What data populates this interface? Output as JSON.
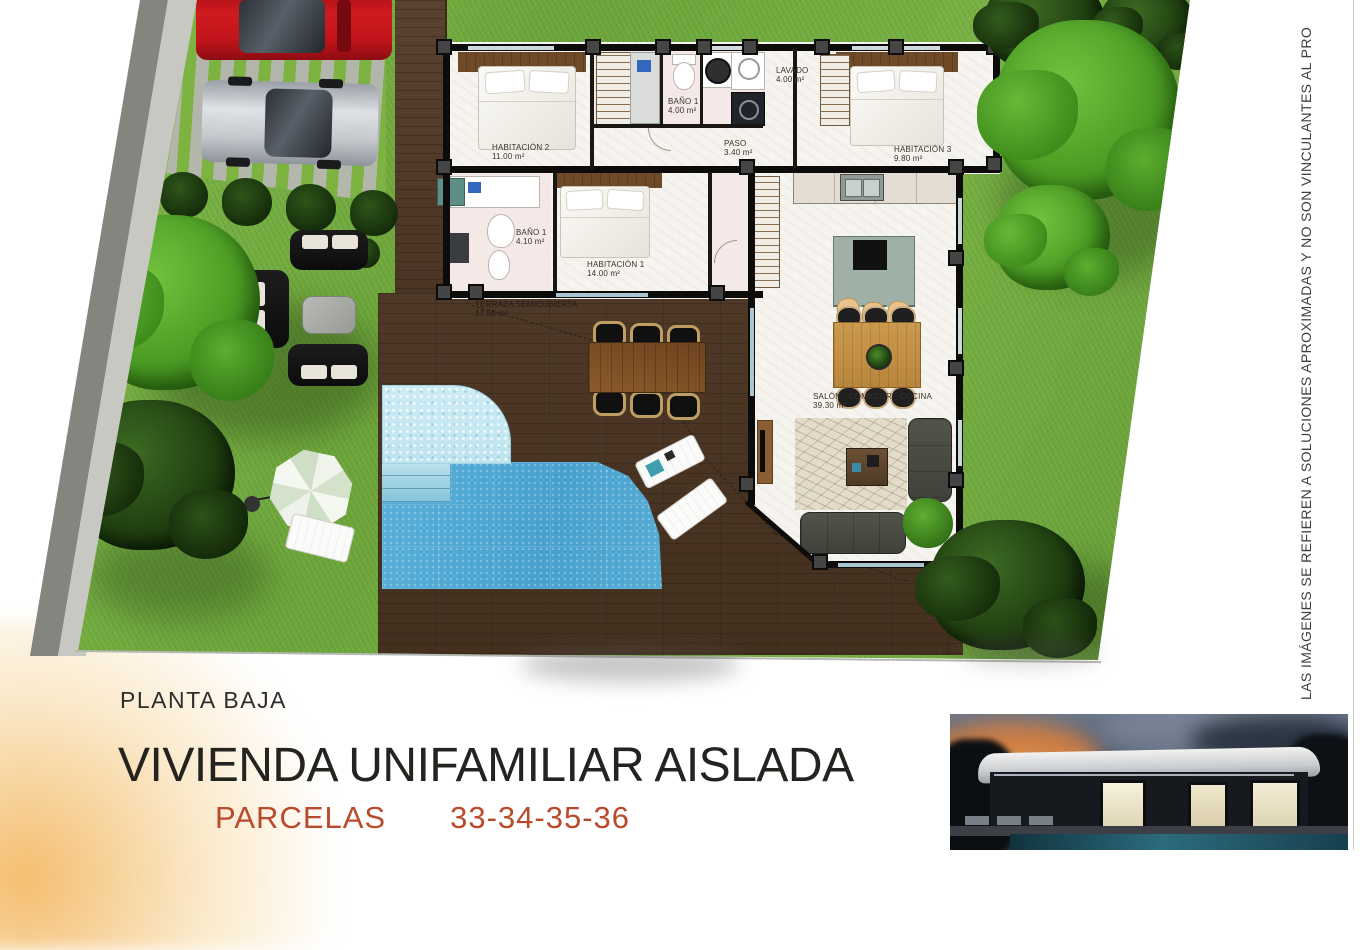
{
  "page": {
    "footer": {
      "floor_label": "PLANTA BAJA",
      "title": "VIVIENDA UNIFAMILIAR AISLADA",
      "parcels_label": "PARCELAS",
      "parcels_numbers": "33-34-35-36"
    },
    "side_note": "LAS IMÁGENES SE REFIEREN A SOLUCIONES APROXIMADAS Y NO SON VINCULANTES AL PRO",
    "colors": {
      "parcels_accent": "#b94a2c",
      "grass": "#6fa93a",
      "pool": "#56aed8",
      "deck_wood": "#4b3627"
    }
  },
  "plan": {
    "rooms": [
      {
        "id": "habitacion-2",
        "name": "HABITACIÓN 2",
        "area": "11.00 m²"
      },
      {
        "id": "bano-1-superior",
        "name": "BAÑO 1",
        "area": "4.00 m²"
      },
      {
        "id": "lavado",
        "name": "LAVADO",
        "area": "4.00 m²"
      },
      {
        "id": "paso",
        "name": "PASO",
        "area": "3.40 m²"
      },
      {
        "id": "habitacion-3",
        "name": "HABITACIÓN 3",
        "area": "9.80 m²"
      },
      {
        "id": "bano-1",
        "name": "BAÑO 1",
        "area": "4.10 m²"
      },
      {
        "id": "habitacion-1",
        "name": "HABITACIÓN 1",
        "area": "14.00 m²"
      },
      {
        "id": "terraza",
        "name": "TERRAZA SEMICUBIERTA",
        "area": "17.60 m²"
      },
      {
        "id": "salon",
        "name": "SALÓN - COMEDOR - COCINA",
        "area": "39.30 m²"
      }
    ]
  }
}
